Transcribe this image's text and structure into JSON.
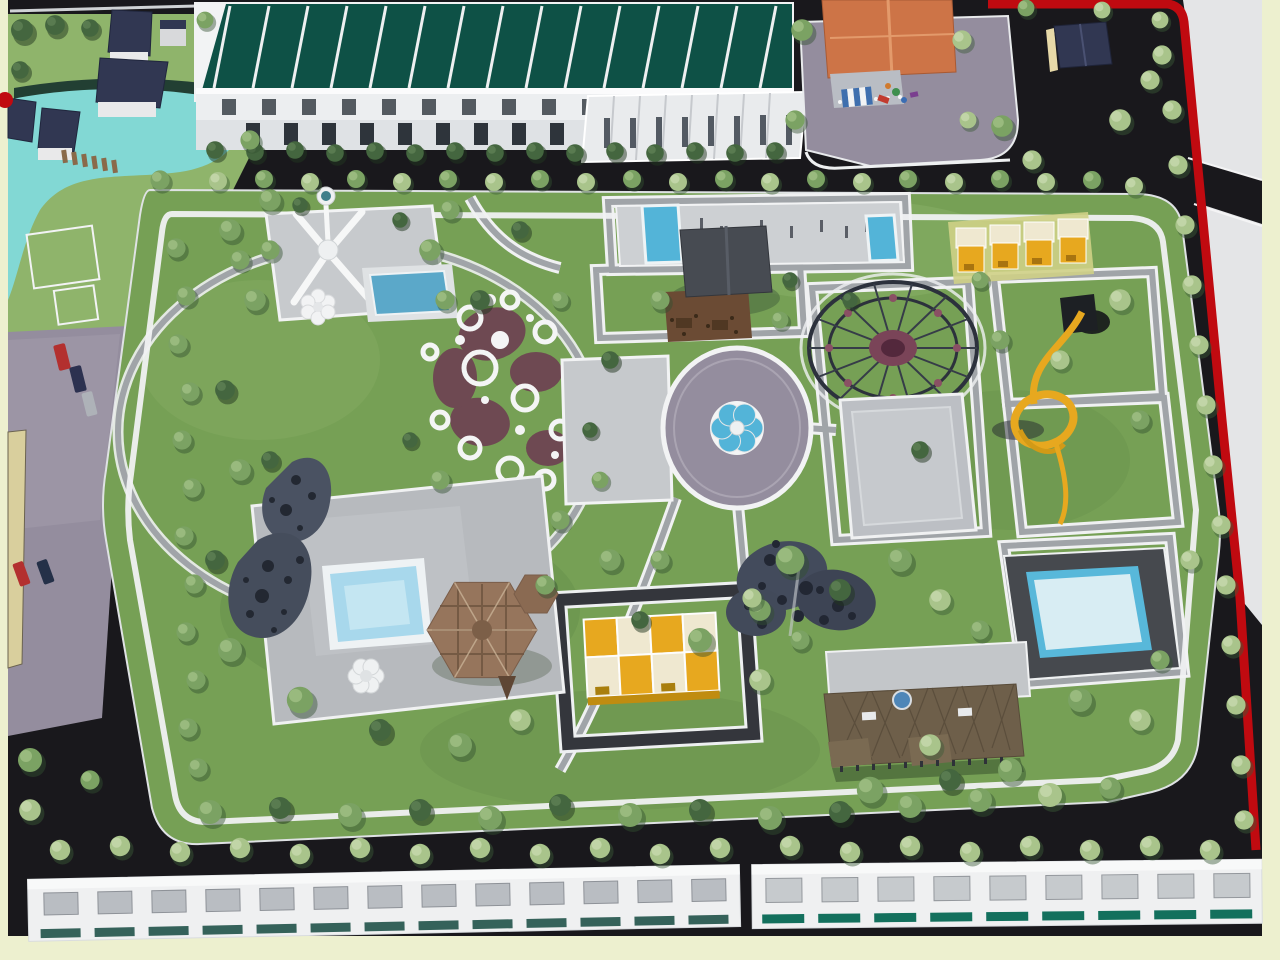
{
  "scene": {
    "scene_type": "3d-aerial-masterplan-render",
    "subject": "bird's-eye 3D rendering of a landscaped central park inside a residential development",
    "palette": {
      "margin": "#edf0cf",
      "asphalt": "#19181c",
      "asphalt_light": "#2c2b30",
      "offsite": "#e4e5e7",
      "grass": "#76a055",
      "grass_light": "#8fb46b",
      "grass_dark": "#587f42",
      "path_gray": "#a0a4a8",
      "path_white": "#f0f1f2",
      "plaza_light": "#c7cacd",
      "paver_purple": "#948d9e",
      "pool_cyan": "#82d8d4",
      "pool_blue": "#53b4d8",
      "pool_pale": "#d8edf3",
      "pool_rim": "#eef3f5",
      "hedge_dark": "#223f33",
      "roof_teal": "#0e5146",
      "roof_navy": "#313752",
      "roof_orange": "#cd7447",
      "roof_brown": "#6e5f4a",
      "fence_red": "#c00a10",
      "yellow": "#e7a81f",
      "yellow_pale": "#efe8d0",
      "cream_wall": "#e7d9a8",
      "maroon": "#6e4052",
      "tent_brown": "#96755c",
      "tent_brown_dark": "#6e543f",
      "canopy_slate": "#434b5c",
      "tree_light": "#a9c48b",
      "tree_mid": "#7ba263",
      "tree_dark": "#44663f",
      "car_red": "#b3302f",
      "car_navy": "#2c3150",
      "teal_strip": "#13705d"
    },
    "objects": [
      "lagoon-pool",
      "villa-cluster",
      "townhouse-row-north",
      "townhouse-row-front",
      "orange-roof-kindergarten",
      "playground-plaza",
      "guard-house",
      "red-boundary-fence",
      "central-park",
      "observation-tower",
      "tower-plaza",
      "tower-pool",
      "flower-ring-garden",
      "central-square-plaza",
      "circular-plaza",
      "flower-fountain",
      "fitness-strip",
      "fitness-pool-west",
      "fitness-pool-east",
      "park-pavilion",
      "wooden-deck",
      "rope-dome-climber",
      "sport-plaza",
      "yellow-pavilion-row",
      "spiral-tube-slide",
      "east-pool",
      "leisure-platform",
      "perforated-blob-sculpture",
      "platform-pool",
      "flower-bench",
      "plaid-dome-tent",
      "perforated-canopy-structures",
      "yellow-cabana-row",
      "clubhouse",
      "clubhouse-forecourt",
      "left-parking-plaza",
      "parked-cars",
      "gazebo-umbrella",
      "townhouse-row-south-left",
      "townhouse-row-south-right",
      "perimeter-walkway",
      "ellipse-walkway",
      "street-trees"
    ]
  }
}
